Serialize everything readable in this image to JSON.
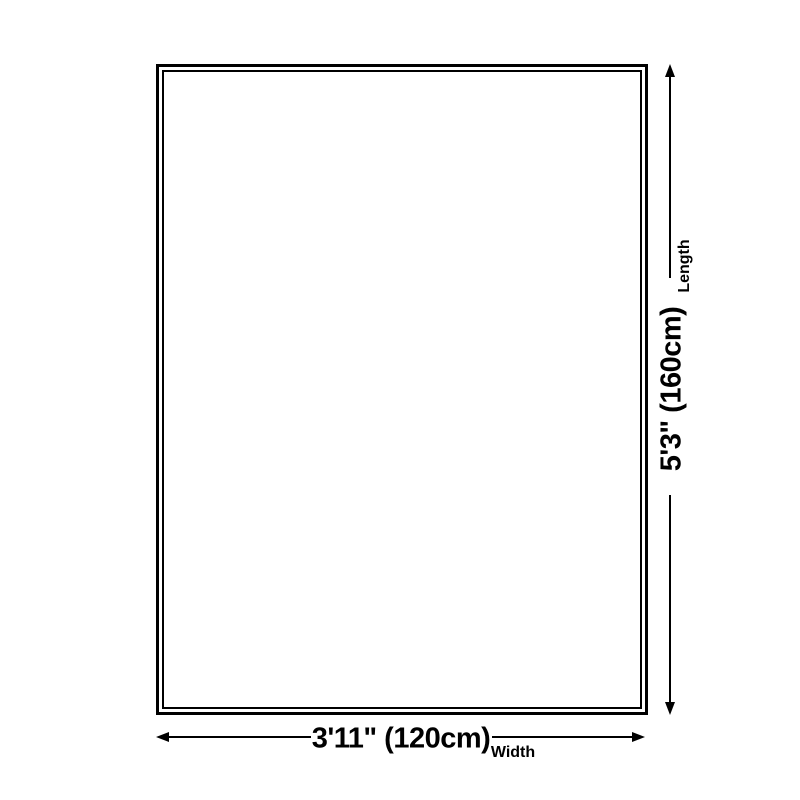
{
  "diagram": {
    "type": "product-dimension-diagram",
    "shape": "rectangle",
    "colors": {
      "background": "#ffffff",
      "line": "#000000",
      "text": "#000000"
    },
    "length": {
      "value": "5'3\" (160cm)",
      "label": "Length"
    },
    "width": {
      "value": "3'11\" (120cm)",
      "label": "Width"
    }
  }
}
